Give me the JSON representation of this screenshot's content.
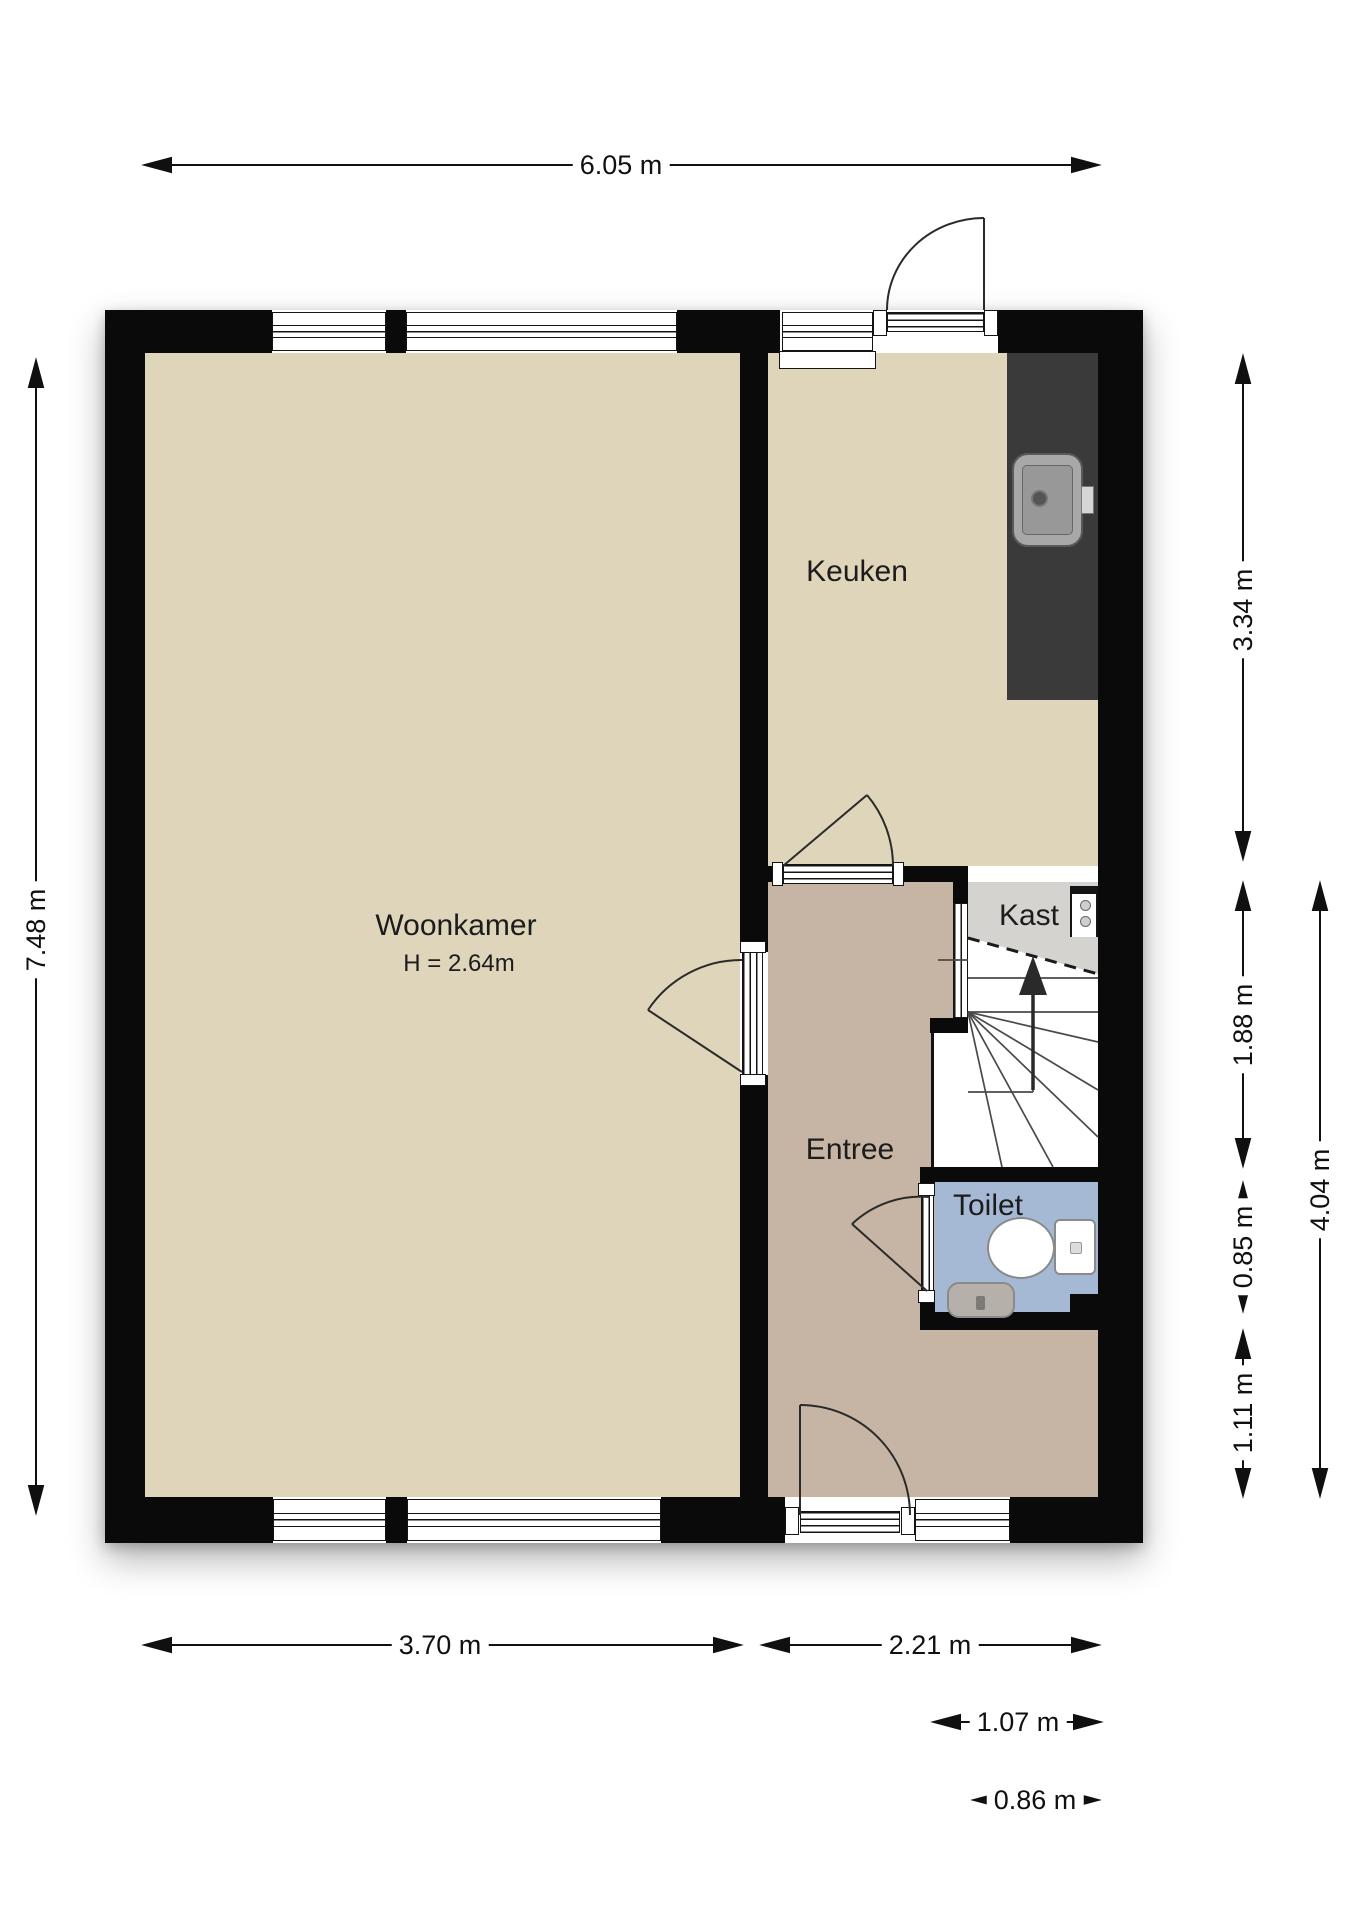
{
  "plan": {
    "title": "floor-plan",
    "rooms": {
      "woonkamer": {
        "label": "Woonkamer",
        "height_note": "H = 2.64m"
      },
      "keuken": {
        "label": "Keuken"
      },
      "entree": {
        "label": "Entree"
      },
      "kast": {
        "label": "Kast"
      },
      "toilet": {
        "label": "Toilet"
      }
    },
    "dimensions": {
      "top_width": "6.05 m",
      "left_height": "7.48 m",
      "right_kitchen_depth": "3.34 m",
      "right_hall_depth": "1.88 m",
      "right_toilet_depth": "0.85 m",
      "right_lower_depth": "1.11 m",
      "right_total_depth": "4.04 m",
      "bottom_livingroom_width": "3.70 m",
      "bottom_entree_width": "2.21 m",
      "bottom_door_width": "1.07 m",
      "bottom_window_width": "0.86 m"
    },
    "fixtures": {
      "kitchen_counter": "counter-top",
      "kitchen_sink": "sink-icon",
      "stairs": "winder-stairs-up-arrow",
      "toilet_bowl": "toilet-icon",
      "toilet_sink": "hand-basin-icon",
      "kast_unit": "meter-cabinet-icon"
    },
    "colors": {
      "wall": "#0a0a0a",
      "floor_living": "#ded5ba",
      "floor_entree": "#c6b5a4",
      "floor_kast": "#d4d3d0",
      "floor_toilet": "#a6b9d4",
      "counter": "#3a3a3a",
      "dimension_text": "#101010"
    }
  }
}
